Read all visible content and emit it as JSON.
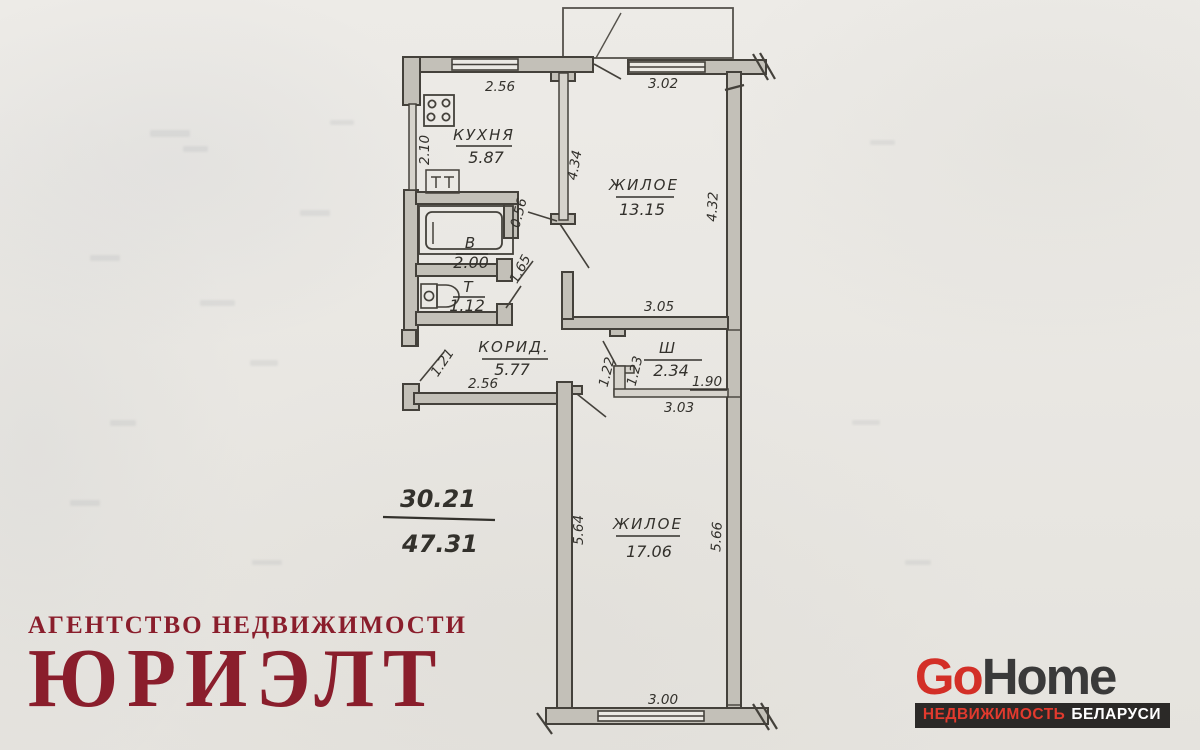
{
  "plan": {
    "rooms": {
      "kitchen": {
        "name": "КУХНЯ",
        "area": "5.87"
      },
      "living1": {
        "name": "ЖИЛОЕ",
        "area": "13.15"
      },
      "bath": {
        "name": "В",
        "area": "2.00"
      },
      "toilet": {
        "name": "Т",
        "area": "1.12"
      },
      "corridor": {
        "name": "КОРИД.",
        "area": "5.77"
      },
      "closet": {
        "name": "Ш",
        "area": "2.34"
      },
      "living2": {
        "name": "ЖИЛОЕ",
        "area": "17.06"
      }
    },
    "dims": {
      "top_left_window": "2.56",
      "top_right_window": "3.02",
      "kitchen_depth": "2.10",
      "partition_height": "4.34",
      "right_wall_height": "4.32",
      "bath_door": "0.56",
      "toilet_door": "1.65",
      "living1_width": "3.05",
      "entrance_door": "1.21",
      "corridor_wall": "2.56",
      "closet_door_left": "1.22",
      "closet_door_right": "1.23",
      "closet_width": "1.90",
      "closet_span": "3.03",
      "living2_height_left": "5.64",
      "living2_height_right": "5.66",
      "living2_window": "3.00"
    },
    "area_summary": {
      "living": "30.21",
      "total": "47.31"
    }
  },
  "branding": {
    "agency_line1": "АГЕНТСТВО НЕДВИЖИМОСТИ",
    "agency_line2": "ЮРИЭЛТ",
    "gohome_go": "Go",
    "gohome_home": "Home",
    "gohome_tagline_left": "НЕДВИЖИМОСТЬ",
    "gohome_tagline_right": "БЕЛАРУСИ"
  },
  "colors": {
    "agency_red": "#8a1e2c",
    "gohome_red": "#d32f27",
    "gohome_dark": "#3a3a3a",
    "tagline_bar": "#2b2927",
    "plan_ink": "#44413b",
    "wall_fill": "#c3c0b8"
  }
}
